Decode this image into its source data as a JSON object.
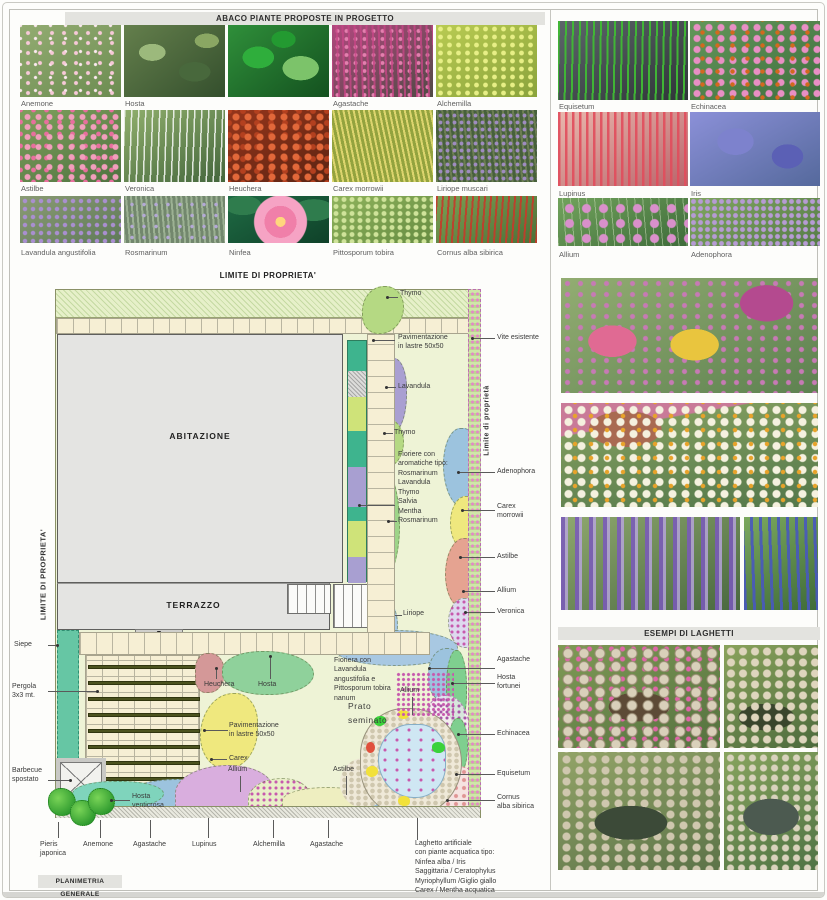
{
  "headers": {
    "abaco": "ABACO PIANTE PROPOSTE IN PROGETTO",
    "laghetti": "ESEMPI DI LAGHETTI",
    "planimetria": "PLANIMETRIA GENERALE"
  },
  "abaco_plants": [
    {
      "label": "Anemone"
    },
    {
      "label": "Hosta"
    },
    {
      "label": ""
    },
    {
      "label": "Agastache"
    },
    {
      "label": "Alchemilla"
    },
    {
      "label": "Astilbe"
    },
    {
      "label": "Veronica"
    },
    {
      "label": "Heuchera"
    },
    {
      "label": "Carex morrowii"
    },
    {
      "label": "Liriope muscari"
    },
    {
      "label": "Lavandula angustifolia"
    },
    {
      "label": "Rosmarinum"
    },
    {
      "label": "Ninfea"
    },
    {
      "label": "Pittosporum tobira"
    },
    {
      "label": "Cornus alba sibirica"
    }
  ],
  "right_plants": [
    {
      "label": "Equisetum"
    },
    {
      "label": "Echinacea"
    },
    {
      "label": "Lupinus"
    },
    {
      "label": "Iris"
    },
    {
      "label": "Allium"
    },
    {
      "label": "Adenophora"
    }
  ],
  "plan": {
    "boundary_top": "LIMITE DI PROPRIETA'",
    "boundary_left": "LIMITE DI PROPRIETA'",
    "boundary_right": "Limite di proprietà",
    "building": "ABITAZIONE",
    "terrace": "TERRAZZO",
    "stairs_arrow": "▼",
    "labels": {
      "thymo1": "Thymo",
      "pav1": "Pavimentazione\nin lastre 50x50",
      "lavandula": "Lavandula",
      "thymo2": "Thymo",
      "fioriere": "Fioriere con\naromatiche tipo:\nRosmarinum\nLavandula\nThymo\nSalvia\nMentha",
      "rosmarinum": "Rosmarinum",
      "liriope": "Liriope",
      "heuchera": "Heuchera",
      "hosta": "Hosta",
      "fioriera2": "Fioriera con\nLavandula\nangustifolia e\nPittosporum tobira\nnanum",
      "prato": "Prato\nseminato",
      "pav2": "Pavimentazione\nin lastre 50x50",
      "carex": "Carex",
      "allium_pond": "Allium",
      "allium_bottom": "Allium",
      "astilbe_pond": "Astilbe",
      "siepe": "Siepe",
      "pergola": "Pergola\n3x3 mt.",
      "barbecue": "Barbecue\nspostato",
      "pieris": "Pieris\njaponica",
      "anemone": "Anemone",
      "agastache1": "Agastache",
      "lupinus": "Lupinus",
      "alchemilla": "Alchemilla",
      "agastache2": "Agastache",
      "hosta_venticrosa": "Hosta\nventicrosa",
      "laghetto": "Laghetto artificiale\ncon piante acquatica tipo:\nNinfea alba / Iris\nSaggittaria / Ceratophylus\nMyriophyllum /Giglio giallo\nCarex / Mentha acquatica"
    },
    "callouts": {
      "vite": "Vite esistente",
      "adenophora": "Adenophora",
      "carex_morrowii": "Carex\nmorrowii",
      "astilbe": "Astilbe",
      "allium": "Allium",
      "veronica": "Veronica",
      "agastache": "Agastache",
      "hosta_fortunei": "Hosta\nfortunei",
      "echinacea": "Echinacea",
      "equisetum": "Equisetum",
      "cornus": "Cornus\nalba sibirica"
    }
  },
  "colors": {
    "lawn": "#eef3d6",
    "building": "#e4e4e2",
    "paving": "#f6efd4",
    "hedge_teal": "#66c6a4",
    "lavandula_purple": "#a99fd1",
    "agastache_blue": "#9cc3de",
    "carex_yellow": "#efe87e",
    "astilbe_salmon": "#e5a391",
    "lupinus_pink": "#d9aede",
    "alchemilla_paleyellow": "#eeeec0",
    "anemone_lavender": "#dcd8ee",
    "water_blue": "#cfe7f3",
    "vine_green": "#cfe6a8",
    "flower_dot_pink": "#d963ae"
  }
}
